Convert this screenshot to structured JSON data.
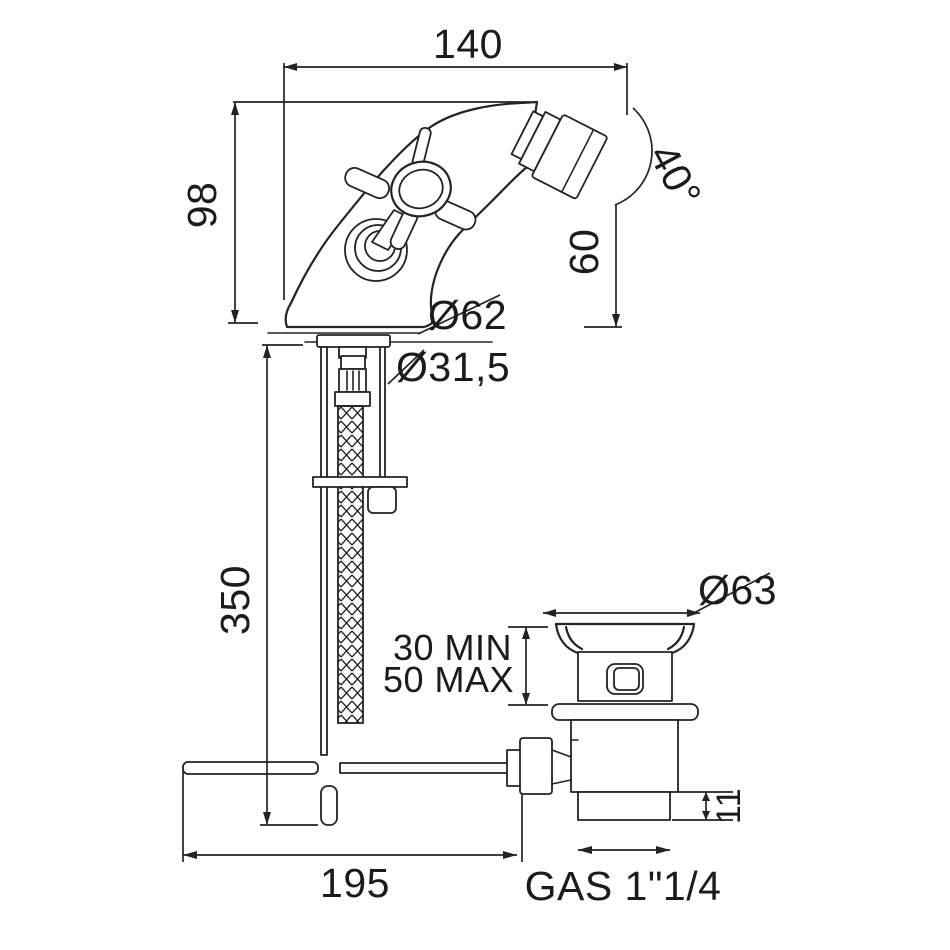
{
  "drawing": {
    "type": "bidet-faucet-technical-drawing",
    "background": "#ffffff",
    "line_color": "#232323",
    "labels": {
      "spout_reach": "140",
      "body_height": "98",
      "spout_angle": "40°",
      "outlet_height": "60",
      "base_diameter": "Ø62",
      "shank_diameter": "Ø31,5",
      "hose_length": "350",
      "drain_flange_diameter": "Ø63",
      "deck_thickness_min": "30 MIN",
      "deck_thickness_max": "50 MAX",
      "tailpiece_height": "11",
      "rod_reach": "195",
      "drain_thread": "GAS 1\"1/4"
    }
  }
}
